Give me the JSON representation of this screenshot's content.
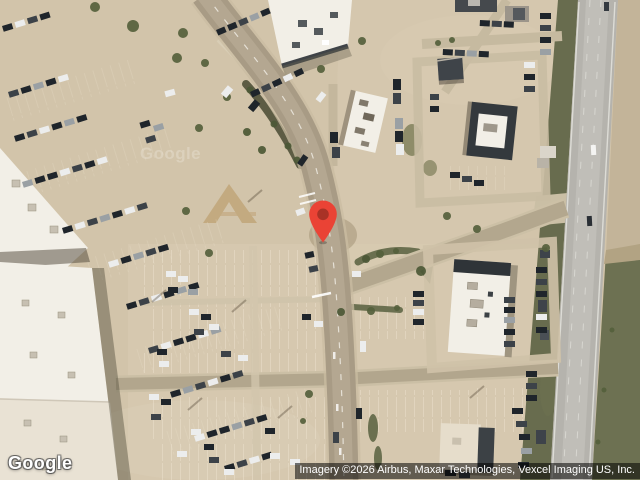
{
  "map": {
    "view": "satellite",
    "google_logo": "Google",
    "attribution": "Imagery ©2026 Airbus, Maxar Technologies, Vexcel Imaging US, Inc.",
    "marker": {
      "icon": "map-pin-icon",
      "color": "#EA4335",
      "dot_color": "#A93226"
    }
  },
  "colors": {
    "terrain": "#d2c4aa",
    "road": "#a89b85",
    "road-curb": "#c9bca2",
    "highway": "#b5b3ad",
    "grass": "#686c4e",
    "building-white": "#f2efe7",
    "building-dark": "#34393d",
    "marker-red": "#EA4335",
    "marker-dot": "#A93226",
    "attribution-bg": "rgba(0,0,0,0.54)",
    "attribution-text": "#ffffff"
  }
}
